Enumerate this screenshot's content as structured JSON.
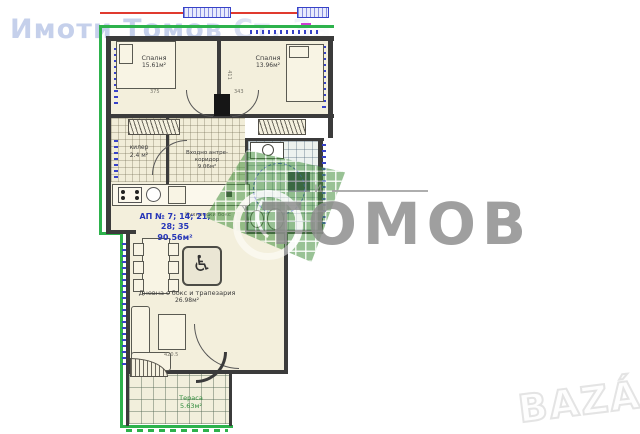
{
  "watermarks": {
    "top_text": "Имоти Томов Ст. Заг",
    "agency_name": "ТОМОВ",
    "agency_tagline": "и",
    "portal_name": "BAZÁR"
  },
  "apartment": {
    "number_line": "АП № 7; 14; 21; 28; 35",
    "total_area": "90.56м²"
  },
  "rooms": {
    "bedroom_left": {
      "label": "Спалня",
      "area": "15.61м²"
    },
    "bedroom_right": {
      "label": "Спалня",
      "area": "13.96м²"
    },
    "closet": {
      "label": "килер",
      "area": "2.4 м²"
    },
    "corridor": {
      "label_line1": "Входно антре-",
      "label_line2": "коридор",
      "area": "9.06м²"
    },
    "kitchen": {
      "label": "Кухненски бокс"
    },
    "living": {
      "label": "Дневна с бокс и трапезария",
      "area": "26.98м²"
    },
    "terrace": {
      "label": "Тераса",
      "area": "5.63м²"
    }
  },
  "dimensions": {
    "bed_left_width": "375",
    "divider_height": "411",
    "bed_right_width": "343",
    "living_width": "420.5"
  },
  "icons": {
    "wheelchair": "♿"
  },
  "colors": {
    "outline_green": "#2db24c",
    "marker_blue": "#3742c8",
    "accent_red": "#e03a2f",
    "area_blue": "#2636b8",
    "logo_green": "#46923f"
  }
}
